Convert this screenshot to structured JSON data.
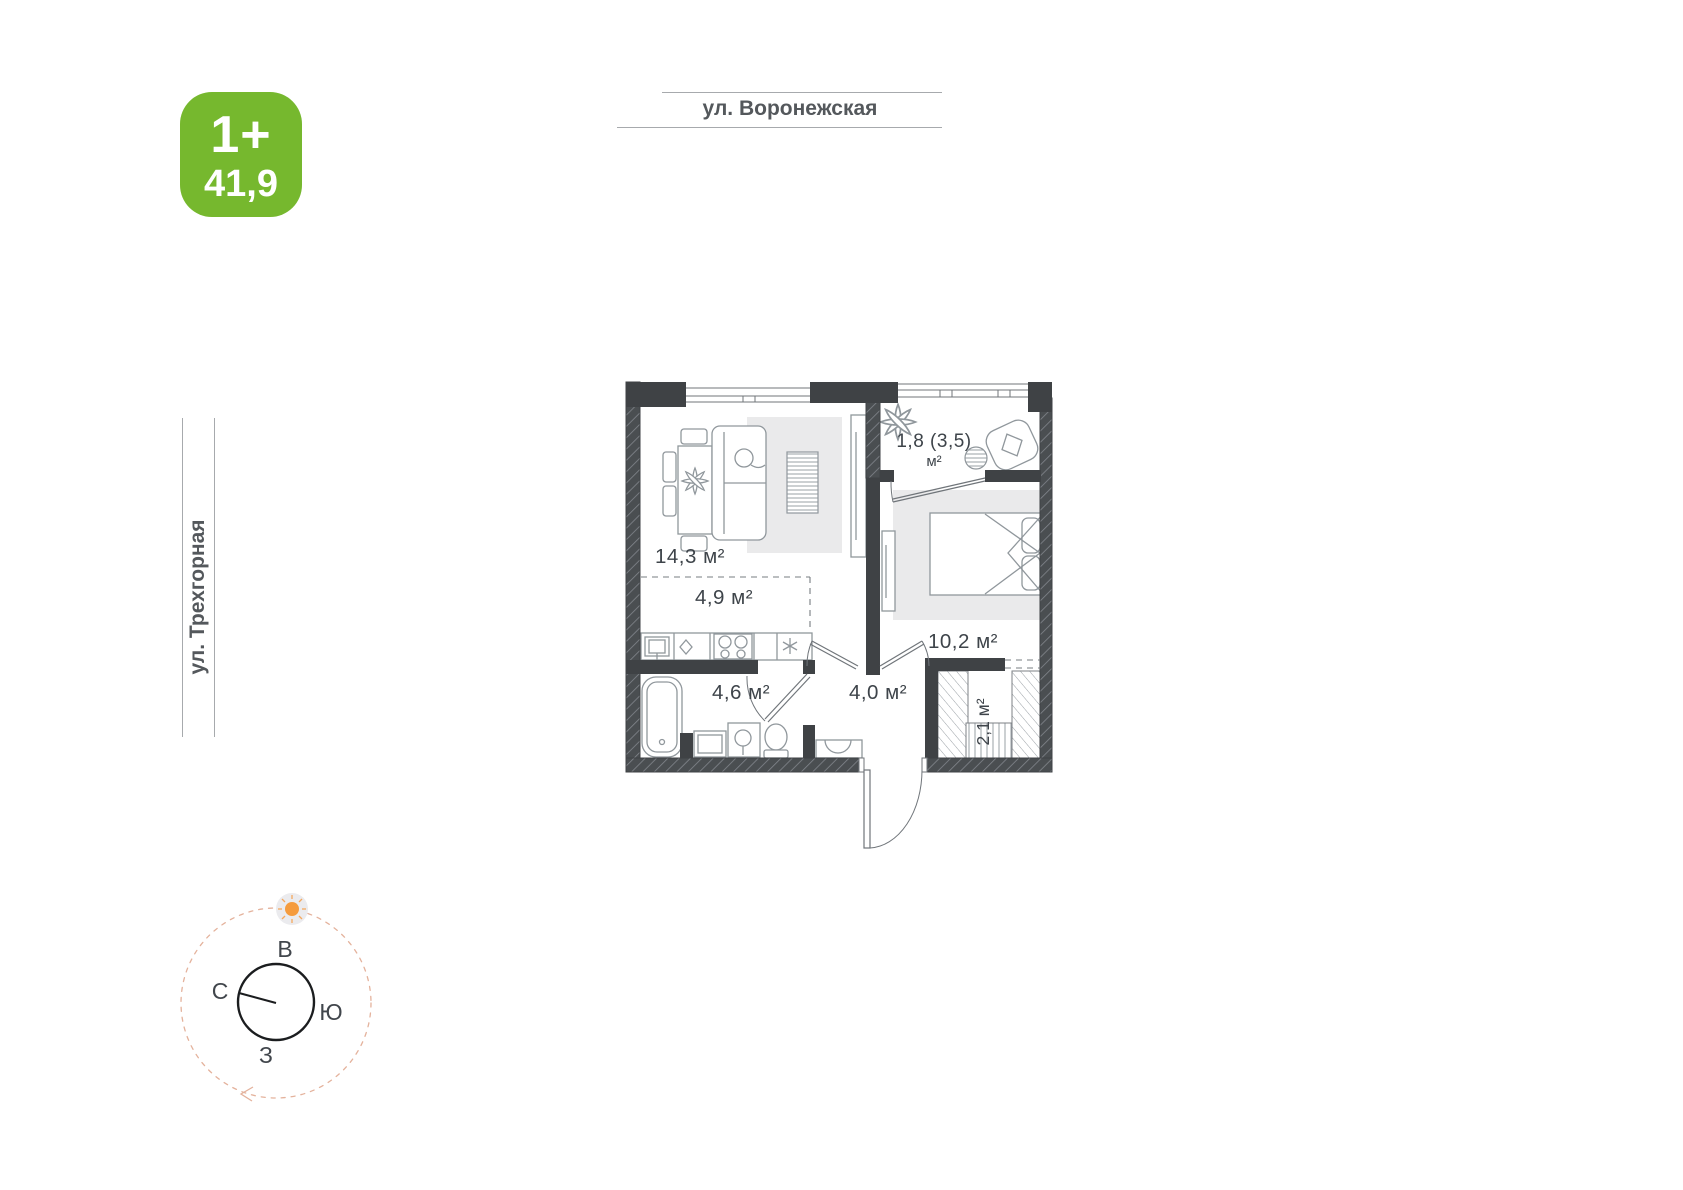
{
  "badge": {
    "type_label": "1+",
    "area_value": "41,9"
  },
  "streets": {
    "top_label": "ул. Воронежская",
    "left_label": "ул. Трехгорная"
  },
  "plan": {
    "labels": {
      "living": "14,3 м²",
      "kitchen": "4,9 м²",
      "bathroom": "4,6 м²",
      "hall": "4,0 м²",
      "bedroom": "10,2 м²",
      "wardrobe": "2,1 м²",
      "balcony_line1": "1,8 (3,5)",
      "balcony_line2": "м²"
    }
  },
  "compass": {
    "east_label": "В",
    "north_label": "С",
    "south_label": "Ю",
    "west_label": "З"
  },
  "colors": {
    "badge_green": "#76b82e",
    "wall_dark": "#3f4245",
    "street_text": "#54585c",
    "street_line": "#a7aaad",
    "label_text": "#3e444a",
    "furniture_gray": "#90979c",
    "rug_gray": "#eaeaeb",
    "sun_orange": "#f59b3d",
    "orbit_salmon": "#e4b29c"
  }
}
